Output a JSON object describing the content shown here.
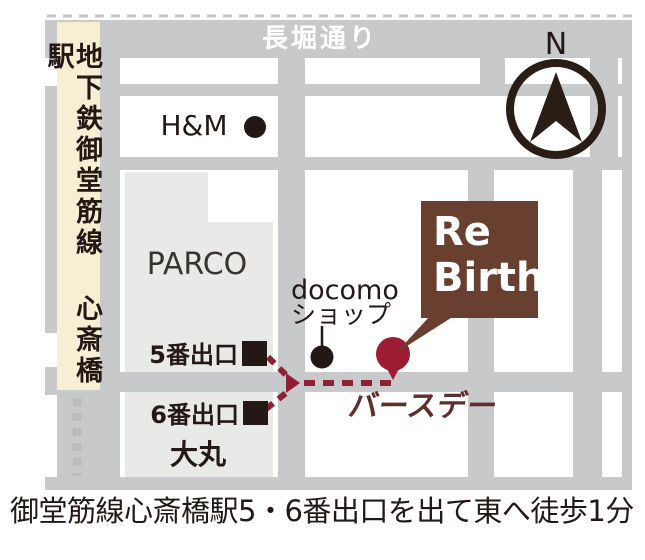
{
  "map": {
    "street_top": "長堀通り",
    "subway_line": "地下鉄御堂筋線 心斎橋駅",
    "landmarks": {
      "hm": "H&M",
      "parco": "PARCO",
      "daimaru": "大丸",
      "docomo_line1": "docomo",
      "docomo_line2": "ショップ"
    },
    "exits": {
      "exit5": "5番出口",
      "exit6": "6番出口"
    },
    "store": {
      "box_line1": "Re",
      "box_line2": "Birth",
      "name_jp": "バースデー"
    },
    "compass_label": "N",
    "caption": "御堂筋線心斎橋駅5・6番出口を出て東へ徒歩1分",
    "colors": {
      "road_gray": "#c8c9ca",
      "block_gray": "#e9e9e8",
      "subway_strip_cream": "#f8eed3",
      "ink_black": "#231815",
      "brand_brown": "#694030",
      "store_name_maroon": "#5f2f2d",
      "route_red": "#8d2133",
      "pin_red": "#9c1c31"
    }
  }
}
